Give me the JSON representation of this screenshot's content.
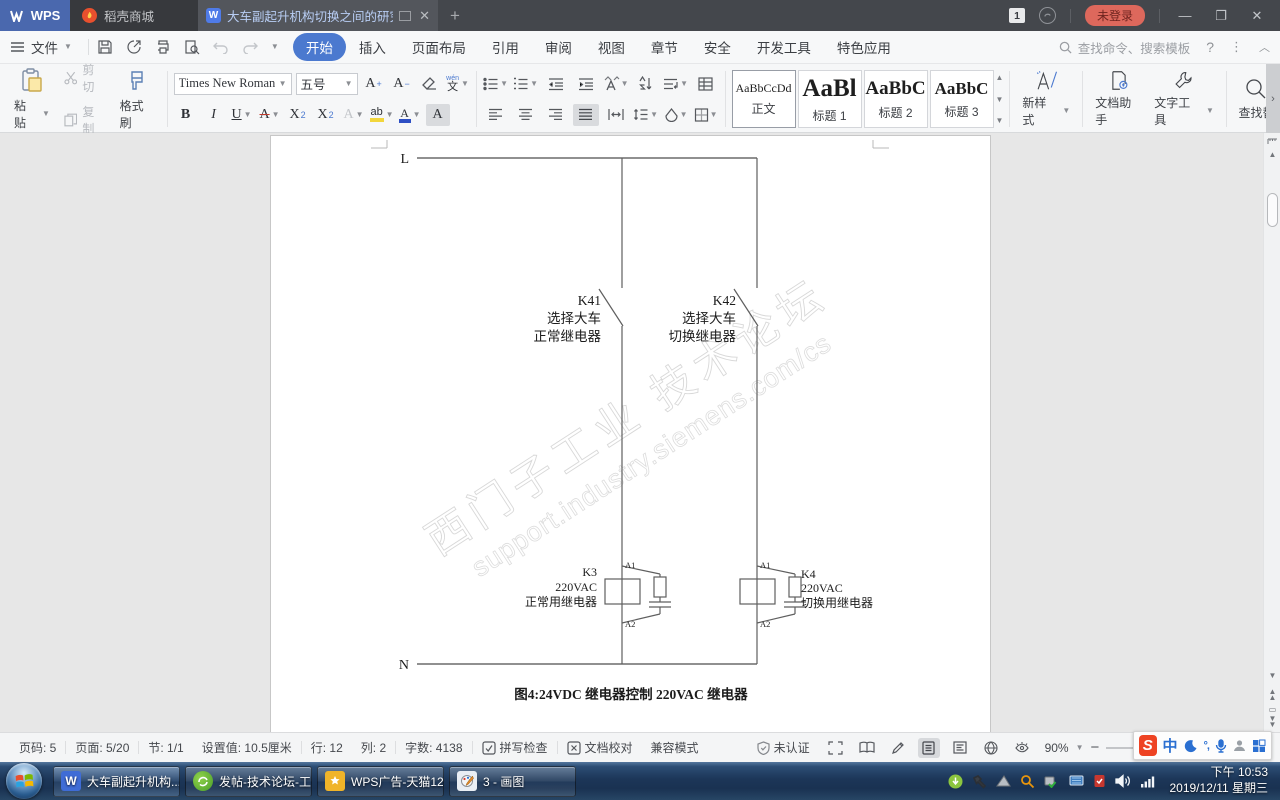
{
  "colors": {
    "accent_blue": "#4b79cf",
    "wps_tab_blue": "#4a68ae",
    "login_badge": "#dd685c",
    "sogou_red": "#ee4323",
    "ime_blue": "#2a6fd1",
    "taskbar_blue": "#1c3658",
    "highlight_yellow": "#f2d63c",
    "font_color_blue": "#2e4fc4",
    "strike_red": "#c0392b"
  },
  "titlebar": {
    "wps_label": "WPS",
    "shop_tab": "稻壳商城",
    "doc_tab": "大车副起升机构切换之间的研究",
    "window_count": "1",
    "login": "未登录"
  },
  "menubar": {
    "file": "文件",
    "tabs": [
      "开始",
      "插入",
      "页面布局",
      "引用",
      "审阅",
      "视图",
      "章节",
      "安全",
      "开发工具",
      "特色应用"
    ],
    "search": "查找命令、搜索模板",
    "help": "?"
  },
  "ribbon": {
    "paste": "粘贴",
    "cut": "剪切",
    "copy": "复制",
    "painter": "格式刷",
    "font_name": "Times New Roman",
    "font_size": "五号",
    "fmt": {
      "bold": "B",
      "italic": "I",
      "underline": "U",
      "strike": "A",
      "sup_x": "X",
      "sup_2": "2",
      "sub_x": "X",
      "sub_2": "2",
      "effect": "A",
      "highlight": "ab",
      "color": "A",
      "shade": "A",
      "a_scale": "A",
      "wen_top": "wén",
      "wen_bottom": "文"
    },
    "styles": [
      {
        "preview": "AaBbCcDd",
        "name": "正文"
      },
      {
        "preview": "AaBl",
        "name": "标题 1"
      },
      {
        "preview": "AaBbC",
        "name": "标题 2"
      },
      {
        "preview": "AaBbC",
        "name": "标题 3"
      }
    ],
    "new_style": "新样式",
    "doc_helper": "文档助手",
    "text_tool": "文字工具",
    "find_replace": "查找替"
  },
  "document": {
    "l": "L",
    "n": "N",
    "a1": "A1",
    "a2": "A2",
    "k41": [
      "K41",
      "选择大车",
      "正常继电器"
    ],
    "k42": [
      "K42",
      "选择大车",
      "切换继电器"
    ],
    "k3": [
      "K3",
      "220VAC",
      "正常用继电器"
    ],
    "k4": [
      "K4",
      "220VAC",
      "切换用继电器"
    ],
    "caption": "图4:24VDC 继电器控制 220VAC 继电器",
    "watermark1": "西门子工业 技术论坛",
    "watermark2": "support.industry.siemens.com/cs"
  },
  "statusbar": {
    "page": "页码: 5",
    "pages": "页面: 5/20",
    "section": "节: 1/1",
    "setting": "设置值: 10.5厘米",
    "line": "行: 12",
    "col": "列: 2",
    "words": "字数: 4138",
    "spell": "拼写检查",
    "proof": "文档校对",
    "compat": "兼容模式",
    "cert": "未认证",
    "zoom": "90%"
  },
  "ime": {
    "zh": "中",
    "sym": "°,"
  },
  "taskbar": {
    "buttons": [
      "大车副起升机构...",
      "发帖-技术论坛-工...",
      "WPS广告-天猫12...",
      "3 - 画图"
    ],
    "time": "下午 10:53",
    "date": "2019/12/11 星期三"
  }
}
